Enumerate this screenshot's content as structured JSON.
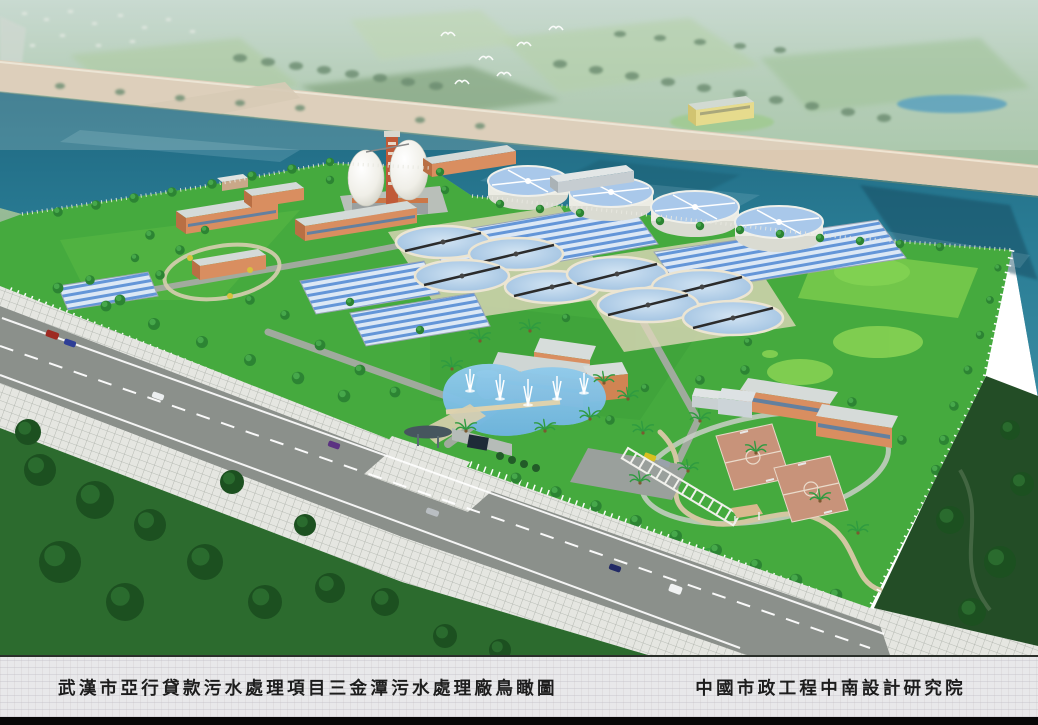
{
  "caption_bar": {
    "title_left": "武漢市亞行貸款污水處理項目三金潭污水處理廠鳥瞰圖",
    "title_right": "中國市政工程中南設計研究院"
  },
  "palette": {
    "lake": "#2a7d95",
    "grass": "#45aa3e",
    "lawn_light": "#72c64a",
    "levee": "#dcc9b2",
    "road": "#8b908b",
    "pond": "#7fc0e6",
    "court": "#c8937a",
    "building_wall": "#d98e60",
    "building_roof": "#d2d8d6",
    "clarifier_water": "#accbe8",
    "basin_stripe": "#6496d8",
    "digester": "#f2f1ea",
    "foreground_green": "#2c6b2e",
    "caption_bg": "#e8e8ea",
    "caption_text": "#1d1d1d",
    "caption_strip": "#070707"
  },
  "scene": {
    "egg_digesters": 2,
    "circular_clarifiers": 8,
    "elevated_tanks": 4,
    "striped_aeration_basins": 5,
    "basketball_courts": 2,
    "fountain_jets": 5,
    "birds": 6,
    "cars_on_road": 7
  }
}
